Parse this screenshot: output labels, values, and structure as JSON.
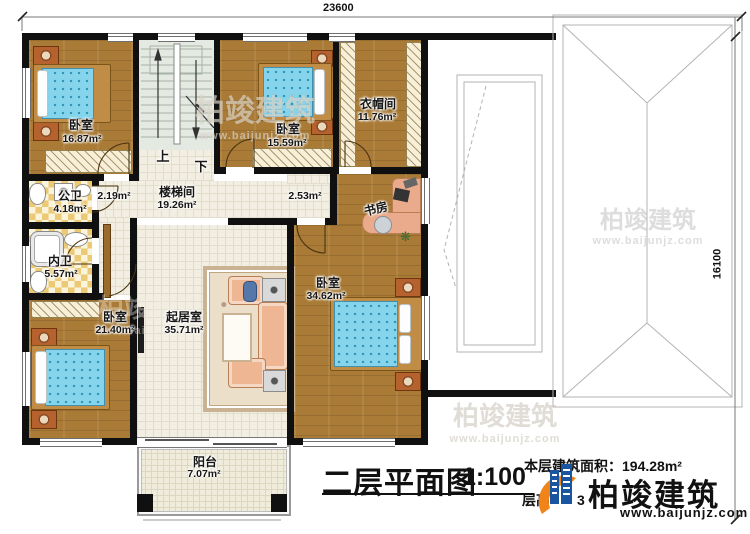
{
  "title": {
    "text": "二层平面图",
    "scale": "1:100"
  },
  "info": {
    "area_line": "本层建筑面积：194.28m²",
    "height_label": "层高",
    "height_visible_digit": "3"
  },
  "brand": {
    "name": "柏竣建筑",
    "site": "www.baijunjz.com"
  },
  "watermark": {
    "name": "柏竣建筑",
    "site": "www.baijunjz.com"
  },
  "dims": {
    "top": "23600",
    "right": "16100"
  },
  "stairs": {
    "up": "上",
    "down": "下",
    "label": "楼梯间",
    "area": "19.26m²"
  },
  "rooms": {
    "bedroom_tl": {
      "name": "卧室",
      "area": "16.87m²"
    },
    "bedroom_tm": {
      "name": "卧室",
      "area": "15.59m²"
    },
    "cloakroom": {
      "name": "衣帽间",
      "area": "11.76m²"
    },
    "hall_nook": {
      "area": "2.19m²"
    },
    "corridor": {
      "area": "2.53m²"
    },
    "study": {
      "name": "书房"
    },
    "public_bath": {
      "name": "公卫",
      "area": "4.18m²"
    },
    "private_bath": {
      "name": "内卫",
      "area": "5.57m²"
    },
    "bedroom_bl": {
      "name": "卧室",
      "area": "21.40m²"
    },
    "living": {
      "name": "起居室",
      "area": "35.71m²"
    },
    "bedroom_r": {
      "name": "卧室",
      "area": "34.62m²"
    },
    "balcony": {
      "name": "阳台",
      "area": "7.07m²"
    }
  },
  "colors": {
    "wall": "#101010",
    "wood": "#a97b36",
    "tile": "#f2efe2",
    "checker": "#ecc974",
    "mattress": "#85d4ec",
    "logo_blue": "#1a56a0",
    "logo_orange": "#f08419"
  }
}
